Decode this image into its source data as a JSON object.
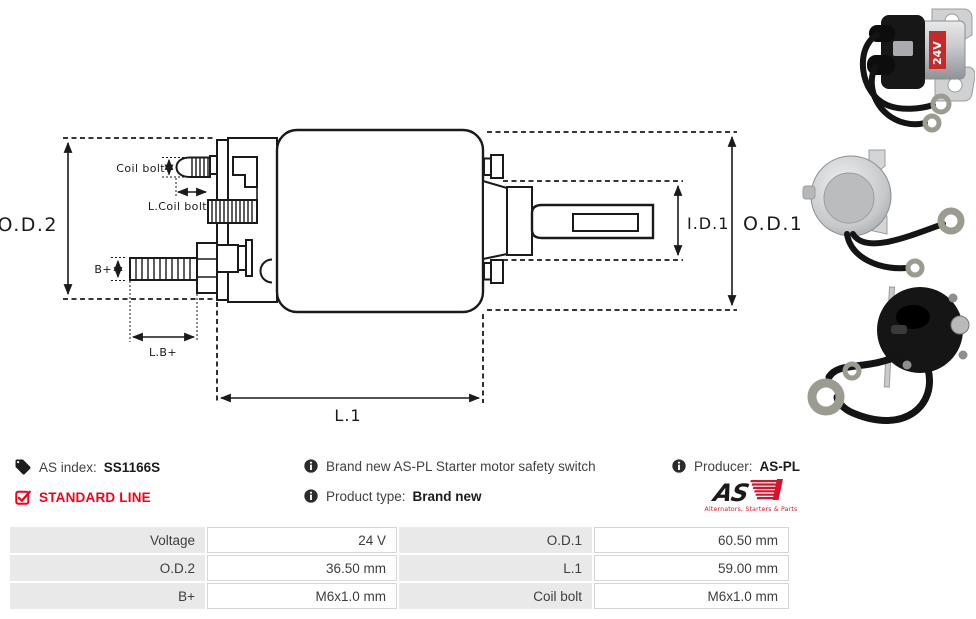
{
  "colors": {
    "accent_red": "#f40019",
    "logo_red": "#d4142b",
    "drawing_stroke": "#1a1a1a",
    "table_label_bg": "#e9e9e9"
  },
  "drawing": {
    "od2_label": "O.D.2",
    "od1_label": "O.D.1",
    "id1_label": "I.D.1",
    "l1_label": "L.1",
    "coil_bolt_label": "Coil bolt",
    "l_coil_bolt_label": "L.Coil bolt",
    "b_plus_label": "B+",
    "l_b_plus_label": "L.B+"
  },
  "photos": {
    "voltage_badge": "24V"
  },
  "info": {
    "as_index_label": "AS index:",
    "as_index_value": "SS1166S",
    "standard_line_label": "STANDARD LINE",
    "description": "Brand new AS-PL Starter motor safety switch",
    "product_type_label": "Product type:",
    "product_type_value": "Brand new",
    "producer_label": "Producer:",
    "producer_value": "AS-PL",
    "logo_as": "AS",
    "logo_caption": "Alternators, Starters & Parts"
  },
  "spec_table": {
    "rows": [
      {
        "label1": "Voltage",
        "value1": "24 V",
        "label2": "O.D.1",
        "value2": "60.50 mm"
      },
      {
        "label1": "O.D.2",
        "value1": "36.50 mm",
        "label2": "L.1",
        "value2": "59.00 mm"
      },
      {
        "label1": "B+",
        "value1": "M6x1.0 mm",
        "label2": "Coil bolt",
        "value2": "M6x1.0 mm"
      }
    ]
  }
}
